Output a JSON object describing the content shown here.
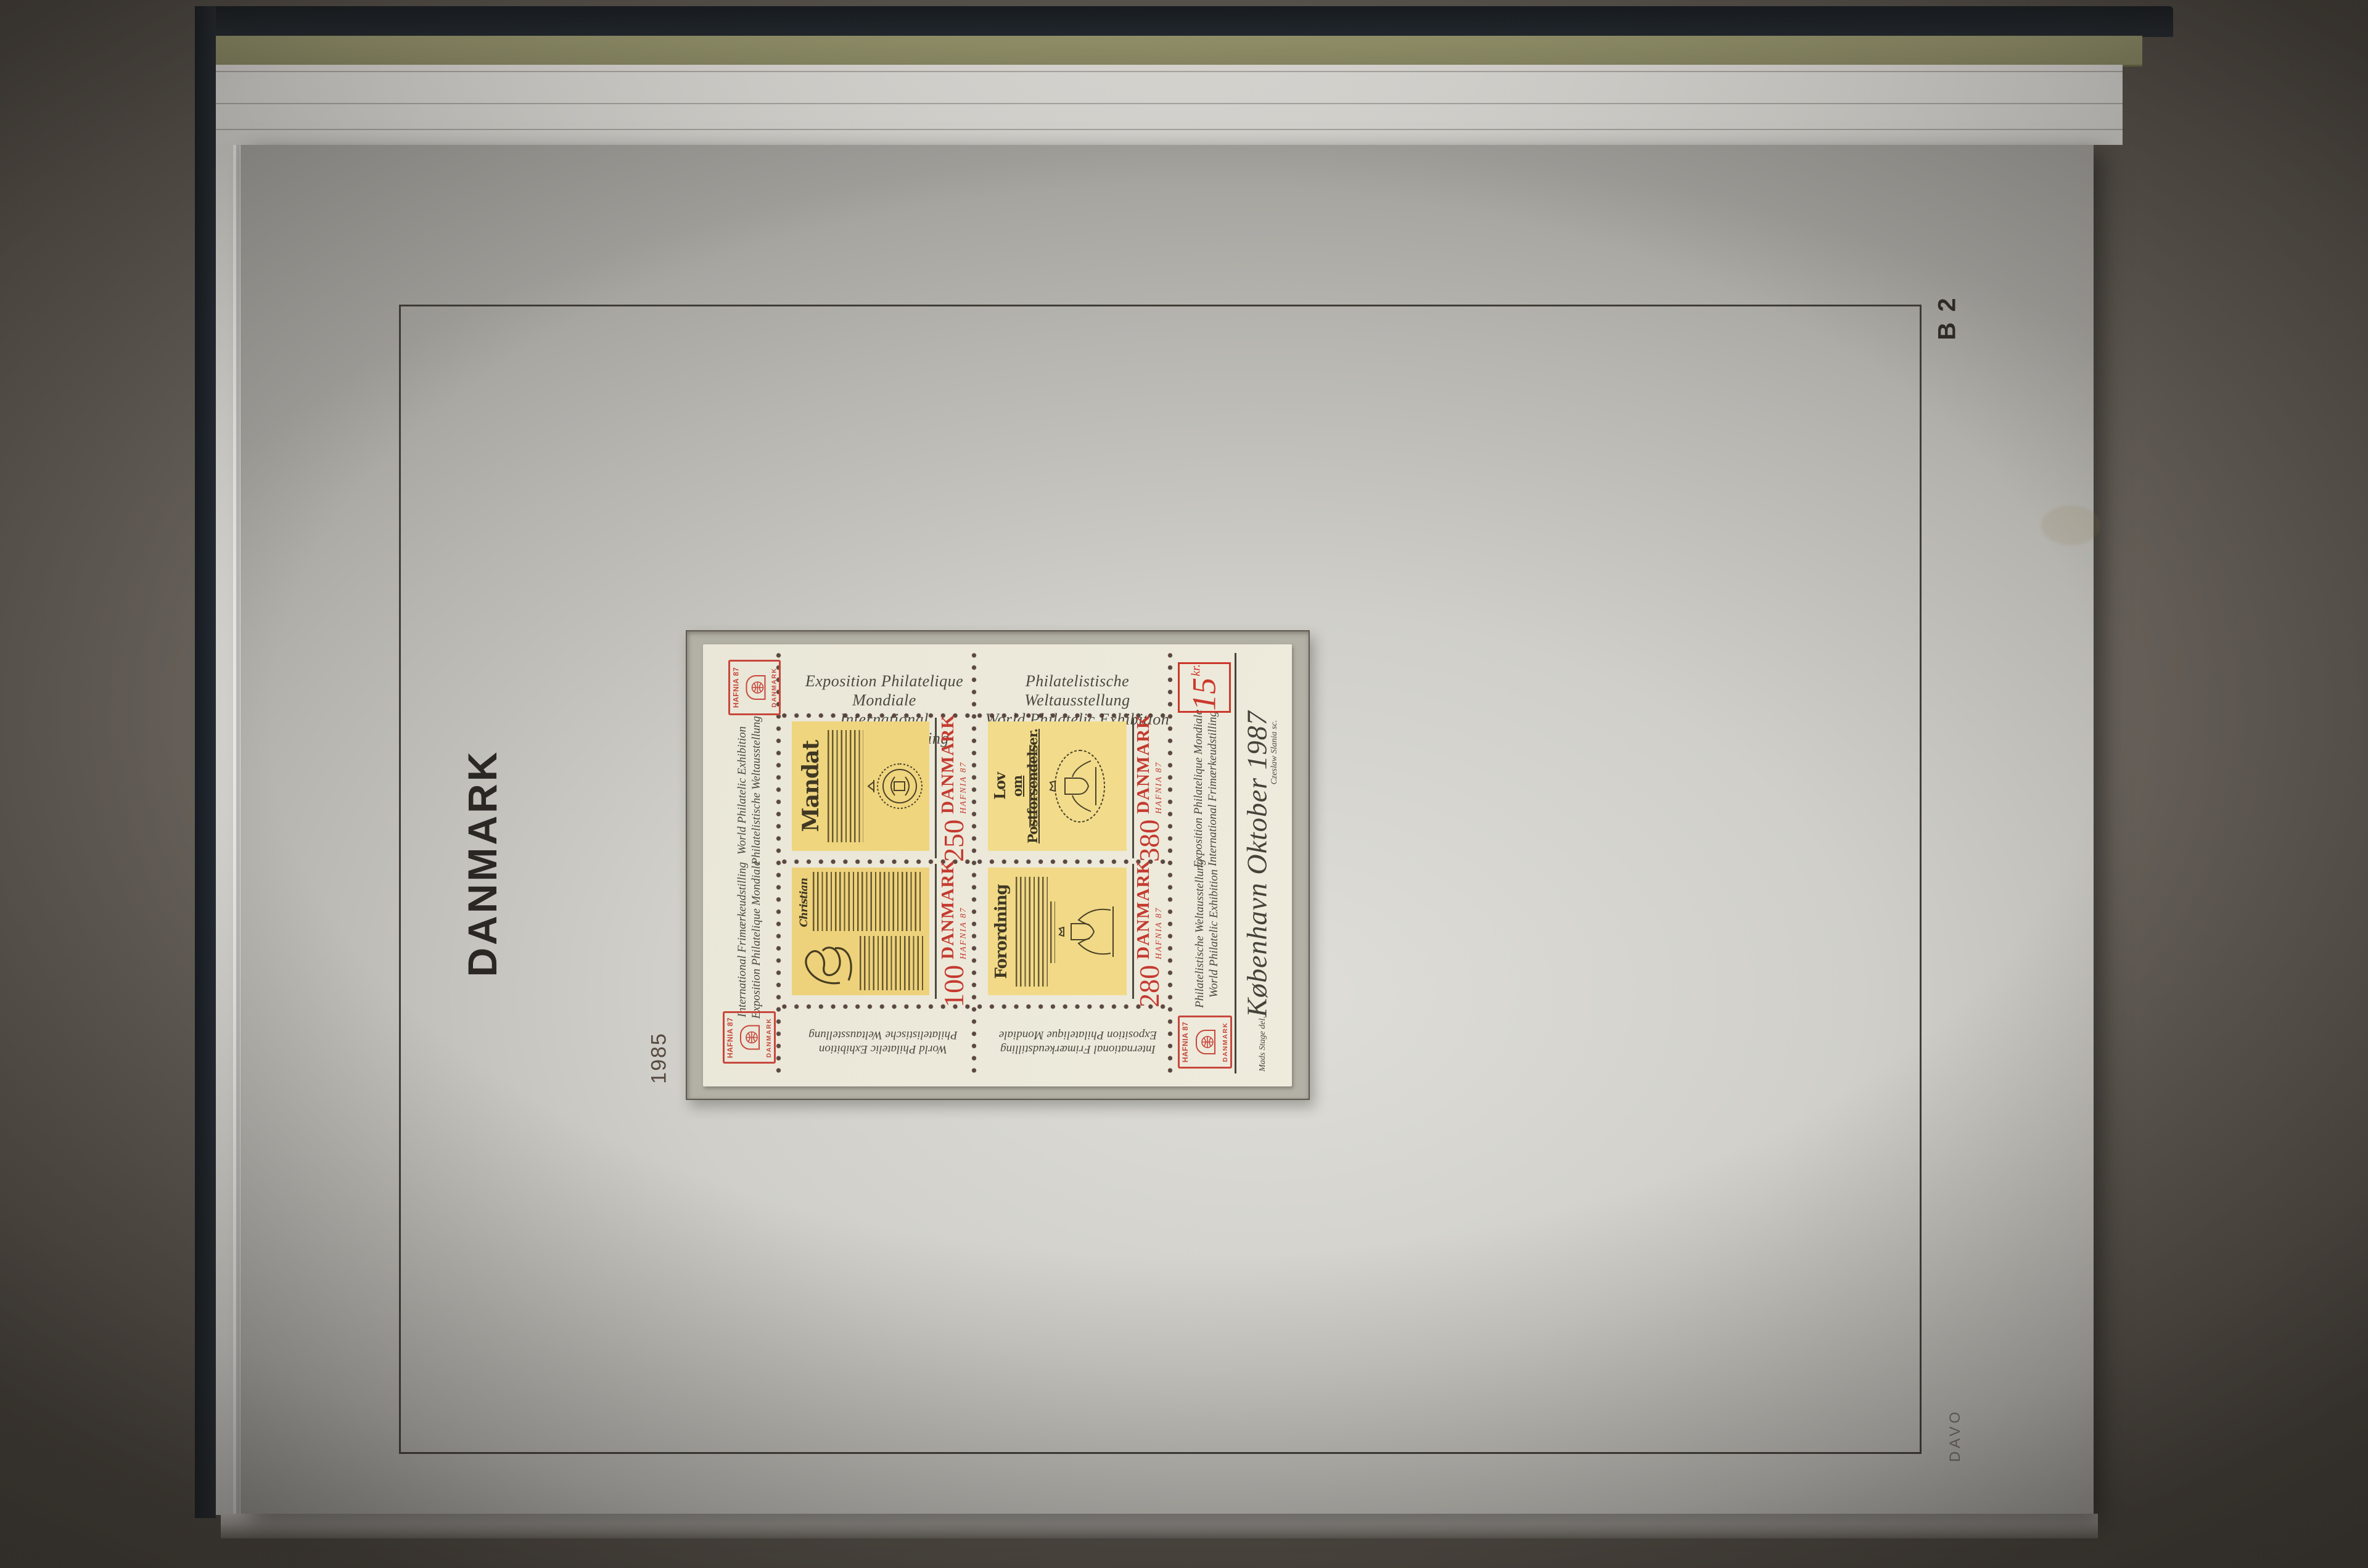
{
  "album_page": {
    "country": "DANMARK",
    "page_code": "B 2",
    "year": "1985",
    "brand": "DAVO"
  },
  "sheet": {
    "margins": {
      "top_left": [
        "Exposition Philatelique Mondiale",
        "International Frimærkeudstilling"
      ],
      "top_right": [
        "Philatelistische Weltausstellung",
        "World Philatelic Exhibition"
      ],
      "left_upper": [
        "World Philatelic Exhibition",
        "Philatelistische Weltausstellung"
      ],
      "left_lower": [
        "International Frimærkeudstilling",
        "Exposition Philatelique Mondiale"
      ],
      "right_upper": [
        "Exposition Philatelique Mondiale",
        "International Frimærkeudstilling"
      ],
      "right_lower": [
        "Philatelistische Weltausstellung",
        "World Philatelic Exhibition"
      ],
      "bottom_left": [
        "World Philatelic Exhibition",
        "Philatelistische Weltausstellung"
      ],
      "bottom_right": [
        "International Frimærkeudstilling",
        "Exposition Philatelique Mondiale"
      ]
    },
    "cachet": "København Oktober 1987",
    "price_value": "15",
    "price_unit": "kr.",
    "engraver_credit": "Czeslaw Slania sc.",
    "designer_credit": "Mads Stage del.",
    "logo": {
      "top": "HAFNIA 87",
      "bottom": "DANMARK"
    },
    "stamps": [
      {
        "title": "Mandat",
        "value": "250",
        "country": "DANMARK",
        "exhibition": "HAFNIA 87",
        "emblem": "royal-seal"
      },
      {
        "title": "Lov",
        "subtitle": "om Postforsendelser.",
        "value": "380",
        "country": "DANMARK",
        "exhibition": "HAFNIA 87",
        "emblem": "coat-of-arms"
      },
      {
        "title": "Christian",
        "value": "100",
        "country": "DANMARK",
        "exhibition": "HAFNIA 87",
        "emblem": "signature-flourish"
      },
      {
        "title": "Forordning",
        "value": "280",
        "country": "DANMARK",
        "exhibition": "HAFNIA 87",
        "emblem": "coat-of-arms-lions"
      }
    ],
    "colors": {
      "sheet_bg": "#ece9da",
      "stamp_document_yellow": "#f0d885",
      "accent_red": "#c8382e",
      "ink": "#45423a",
      "perforation": "#4e3a33",
      "mount_gray": "#b3b0a5",
      "page_gray": "#cfcec9",
      "frame_line": "#403d37",
      "cover_black": "#1d232a",
      "interleaf_olive": "#9a996e",
      "backdrop": "#6b655e"
    }
  }
}
